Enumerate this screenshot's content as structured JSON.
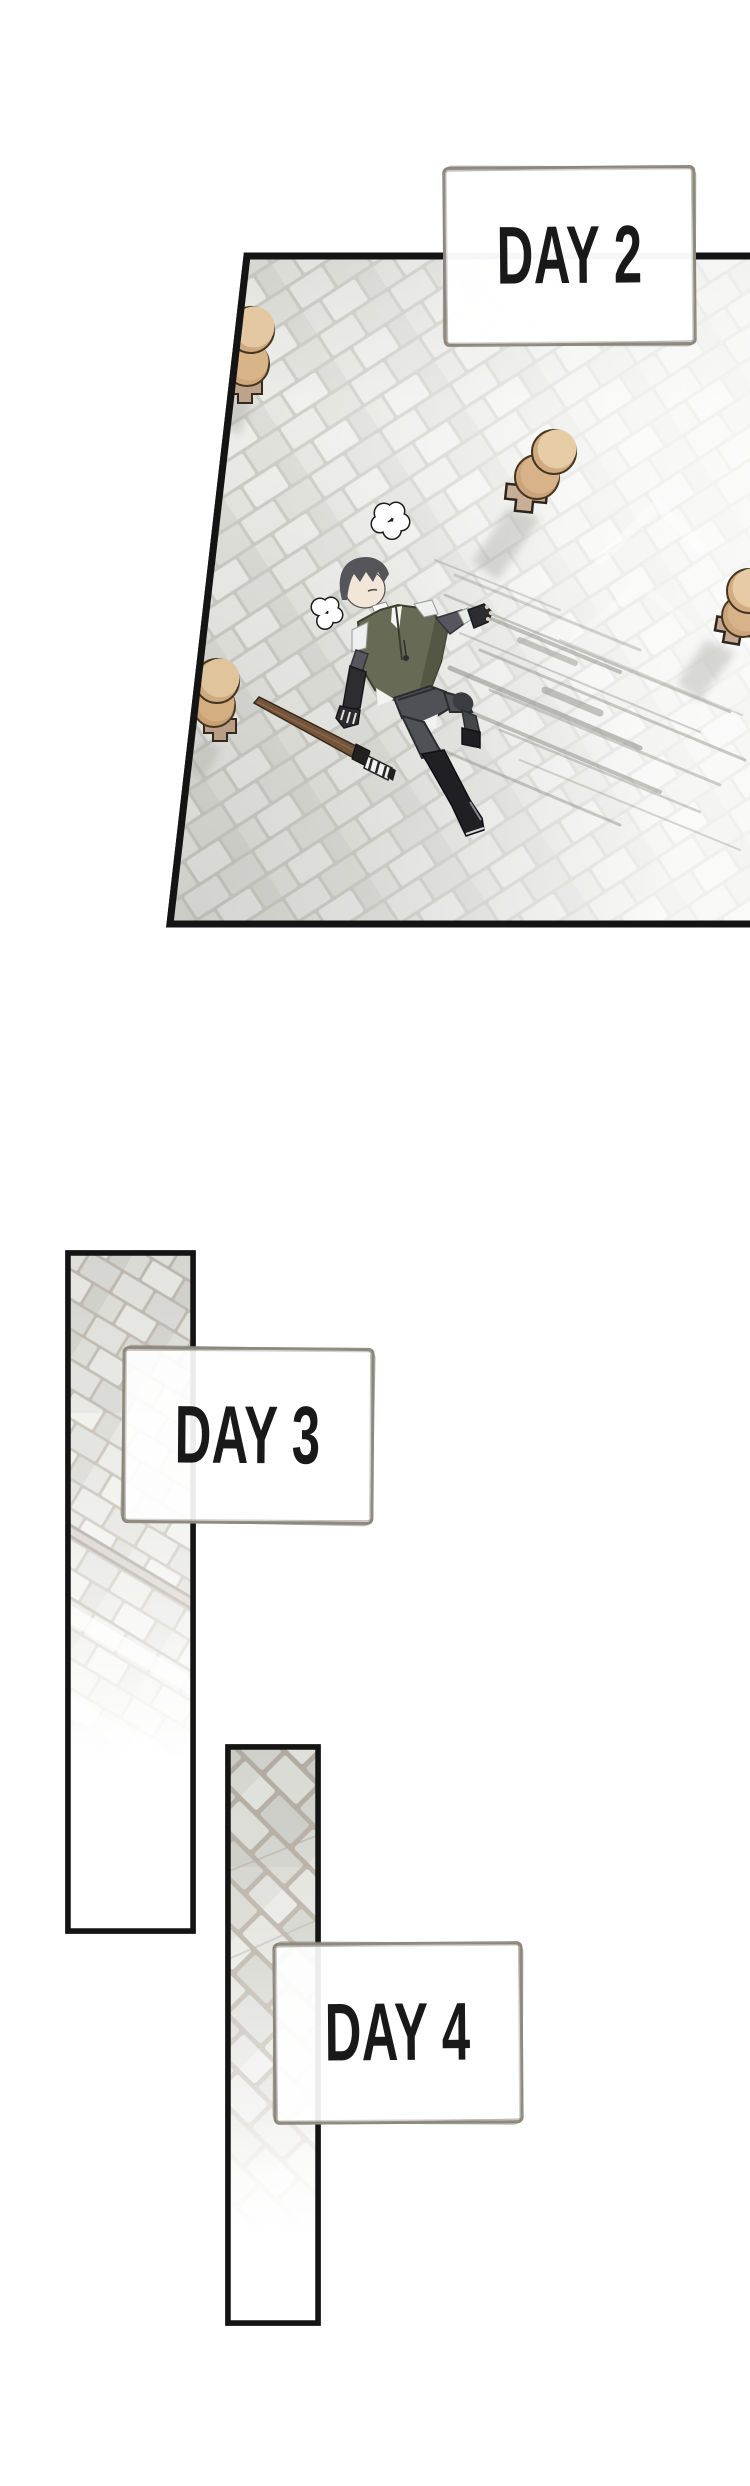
{
  "page": {
    "width": 750,
    "height": 2486,
    "background": "#ffffff",
    "type": "webtoon-training-montage"
  },
  "panels": [
    {
      "id": "panel-day2",
      "label": "DAY 2",
      "scene": "Top-down view of a cobblestone training yard; a dark-haired trainee lies sprawled on his back beside a wooden practice sword, breath puffs rising, striking posts around him"
    },
    {
      "id": "panel-day3",
      "label": "DAY 3",
      "scene": "Tall narrow panel of the diagonal cobblestone training ground with a wooden edge rail, fading to white"
    },
    {
      "id": "panel-day4",
      "label": "DAY 4",
      "scene": "Tall narrow panel of diagonal cobblestones fading to white"
    }
  ],
  "colors": {
    "panel_border": "#141414",
    "label_box_border": "#8f897f",
    "label_text": "#191919",
    "floor_stone_light": "#ededea",
    "floor_stone_dark": "#d9d9d4",
    "floor_joint": "#c9c9c3",
    "post_top": "#e7cda6",
    "post_shade": "#cba47a",
    "post_base": "#c7ae97",
    "character_hair": "#56545b",
    "character_skin": "#f2e6d8",
    "character_vest": "#676a54",
    "character_pants": "#505057",
    "character_boots": "#1f1f24",
    "sword_wood": "#74543a",
    "speed_line": "#8b8b86"
  }
}
